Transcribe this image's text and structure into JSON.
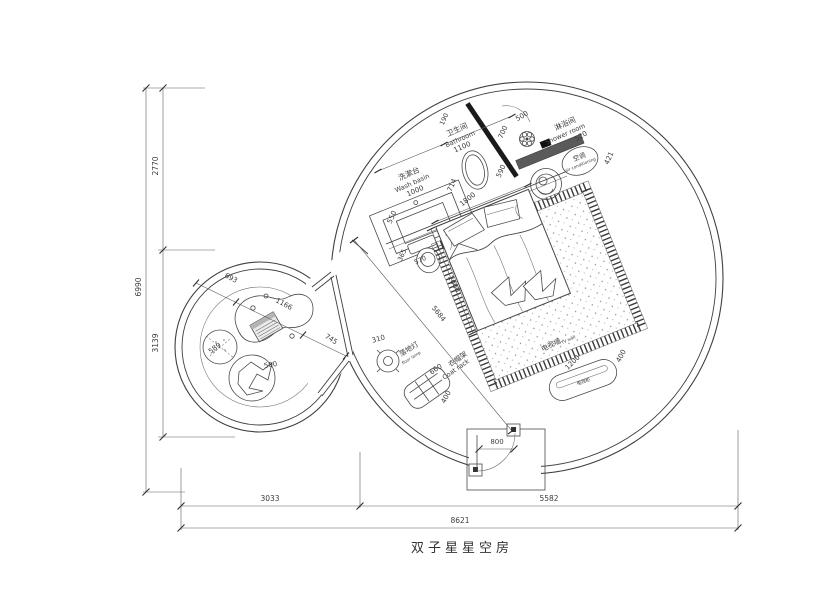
{
  "title": "双子星星空房",
  "labels": {
    "washbasin_zh": "洗漱台",
    "washbasin_en": "Wash basin",
    "bathroom_zh": "卫生间",
    "bathroom_en": "Bathroom",
    "shower_zh": "淋浴间",
    "shower_en": "Shower room",
    "ac_zh": "空调",
    "ac_en": "air conditioning",
    "floor_lamp_zh": "落地灯",
    "floor_lamp_en": "floor lamp",
    "coat_rack_zh": "衣帽架",
    "coat_rack_en": "Coat rack",
    "tv_wall_zh": "电视墙",
    "tv_wall_en": "TV wall",
    "tv_cabinet_zh": "电视柜"
  },
  "dims": {
    "basin_length": "1000",
    "counter_depth": "550",
    "bath_width": "1100",
    "wall_stub": "190",
    "bath_door": "700",
    "shower_door": "500",
    "shower_width": "590",
    "ac_width": "520",
    "ac_gap": "421",
    "toilet_gap": "714",
    "bed_width": "1800",
    "toilet_width": "365",
    "toilet_depth": "570",
    "bed_length": "2000",
    "room_diagonal": "5684",
    "lamp_diameter": "310",
    "rack_length": "660",
    "rack_depth": "400",
    "tv_length": "1200",
    "tv_depth": "400",
    "entry_door": "800",
    "lounge_gap_left": "693",
    "lounge_table": "1166",
    "lounge_gap_right": "745",
    "pouf_diameter": "589",
    "chair_diameter": "500",
    "left_upper": "2770",
    "left_lower": "3139",
    "left_total": "6990",
    "bottom_left": "3033",
    "bottom_right": "5582",
    "bottom_total": "8621"
  },
  "colors": {
    "line": "#3f3f3f",
    "wall_fill": "#1a1a1a",
    "shower_bench": "#5a5a5a",
    "background": "#ffffff"
  }
}
